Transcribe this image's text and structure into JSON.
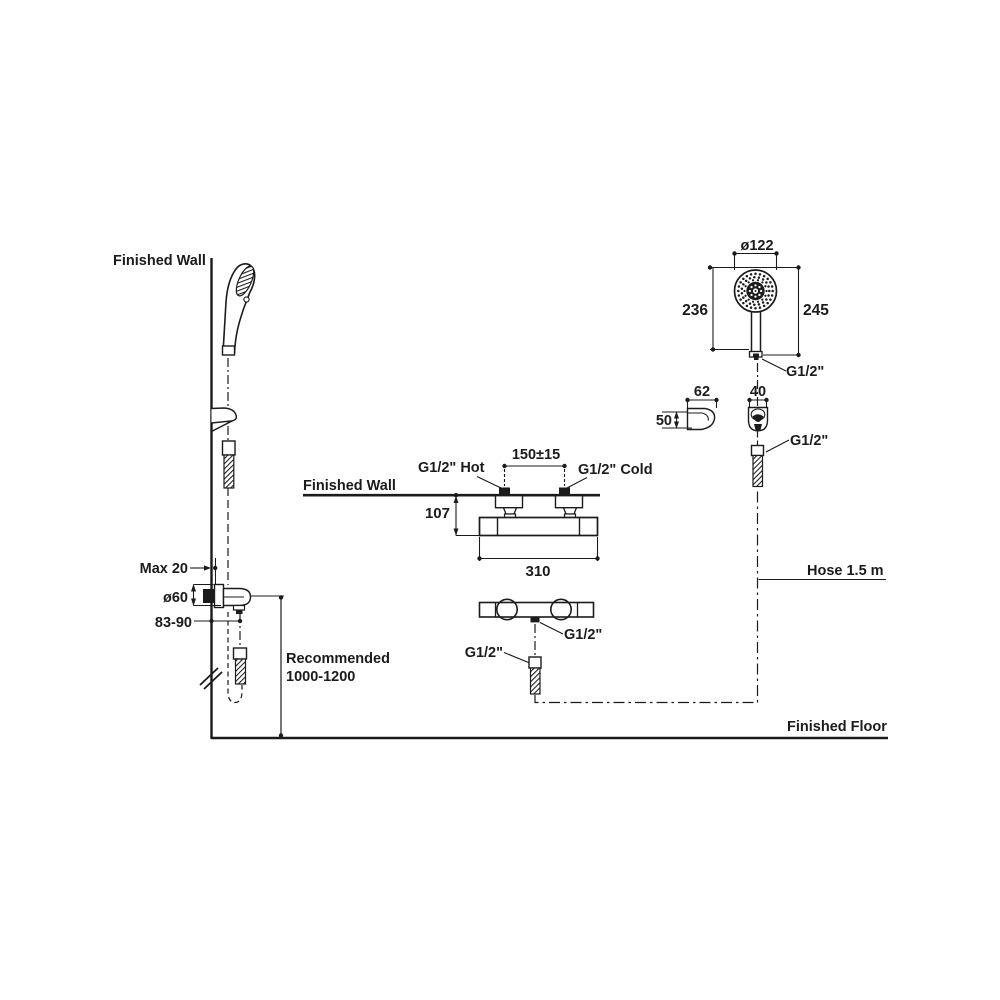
{
  "diagram_title": "Shower mixer installation dimension drawing",
  "colors": {
    "line": "#1b1b1b",
    "background": "#ffffff"
  },
  "labels": {
    "finished_wall_top": "Finished Wall",
    "finished_wall_mid": "Finished Wall",
    "finished_floor": "Finished Floor",
    "hose": "Hose 1.5 m",
    "recommended_line1": "Recommended",
    "recommended_line2": "1000-1200",
    "max20": "Max 20",
    "dia60": "ø60",
    "d83_90": "83-90",
    "hot": "G1/2\" Hot",
    "cold": "G1/2\" Cold",
    "d150": "150±15",
    "d107": "107",
    "d310": "310",
    "g12_mixer_outlet": "G1/2\"",
    "g12_hose_mid": "G1/2\"",
    "dia122": "ø122",
    "d236": "236",
    "d245": "245",
    "g12_handle": "G1/2\"",
    "d62": "62",
    "d50": "50",
    "d40": "40",
    "g12_hose_right": "G1/2\""
  }
}
